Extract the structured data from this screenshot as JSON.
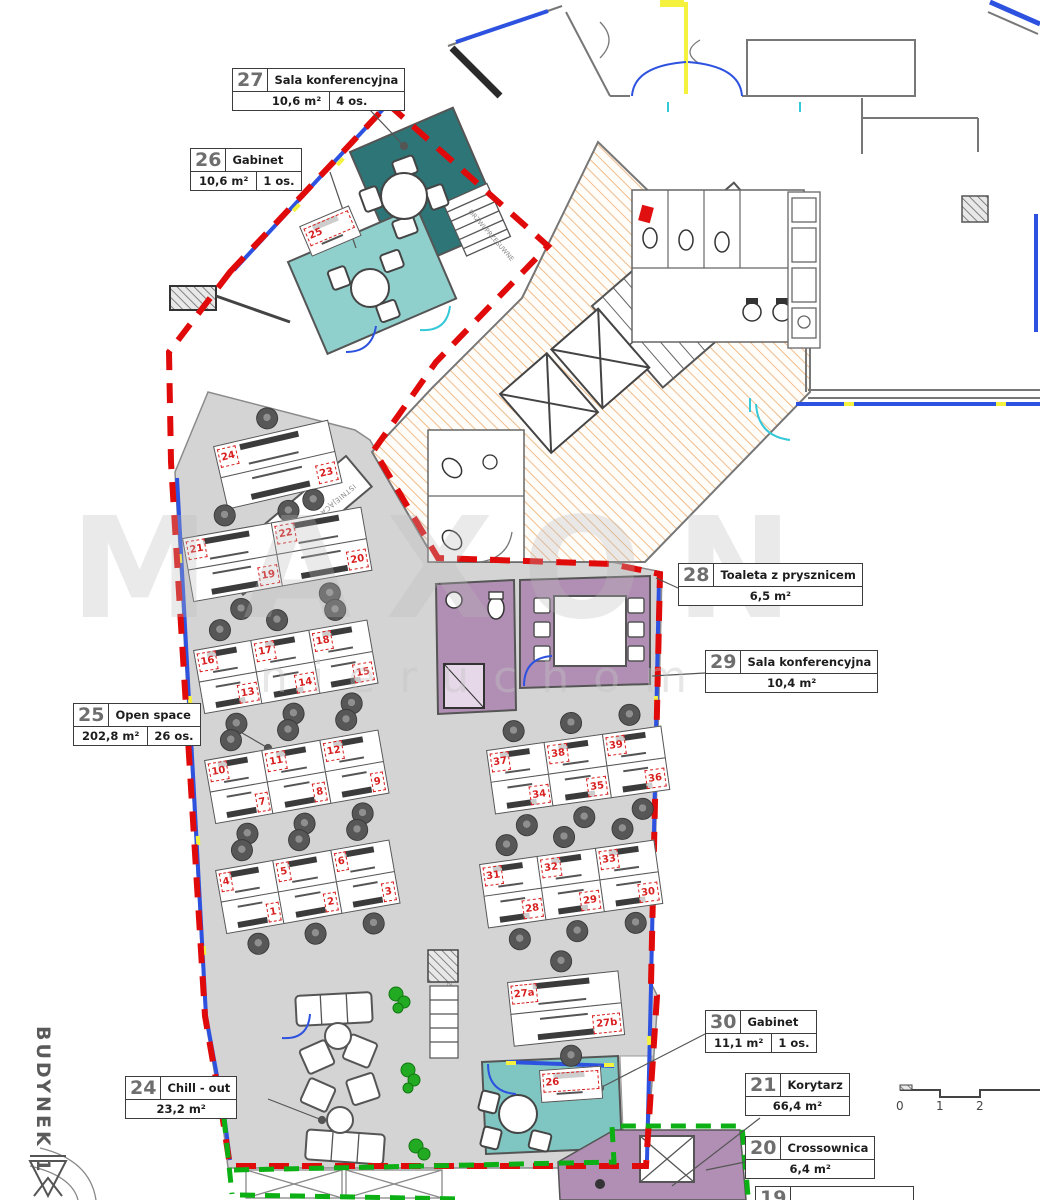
{
  "building_label": "BUDYNEK 1",
  "watermark": {
    "line1": "MAXON",
    "line2": "nieruchomości"
  },
  "scale_bar": {
    "ticks": [
      "0",
      "1",
      "2"
    ]
  },
  "room_labels": [
    {
      "id": "27",
      "name": "Sala konferencyjna",
      "area": "10,6 m²",
      "capacity": "4 os."
    },
    {
      "id": "26",
      "name": "Gabinet",
      "area": "10,6 m²",
      "capacity": "1 os."
    },
    {
      "id": "28",
      "name": "Toaleta z prysznicem",
      "area": "6,5 m²",
      "capacity": ""
    },
    {
      "id": "29",
      "name": "Sala konferencyjna",
      "area": "10,4 m²",
      "capacity": ""
    },
    {
      "id": "25",
      "name": "Open space",
      "area": "202,8 m²",
      "capacity": "26 os."
    },
    {
      "id": "24",
      "name": "Chill - out",
      "area": "23,2 m²",
      "capacity": ""
    },
    {
      "id": "30",
      "name": "Gabinet",
      "area": "11,1 m²",
      "capacity": "1 os."
    },
    {
      "id": "21",
      "name": "Korytarz",
      "area": "66,4 m²",
      "capacity": ""
    },
    {
      "id": "20",
      "name": "Crossownica",
      "area": "6,4 m²",
      "capacity": ""
    },
    {
      "id": "19",
      "name": "",
      "area": "",
      "capacity": ""
    }
  ],
  "annotations": {
    "builtin_furniture": "ISTNIEJĄCA ZABUDOWA MEBLOWA",
    "sliding_door_1": "DRZWI PRZESUWNE",
    "sliding_door_2": "DRZWI PRZESUWNE"
  },
  "desk_clusters": [
    {
      "rows": [
        [
          "24"
        ],
        [
          "23"
        ]
      ]
    },
    {
      "rows": [
        [
          "21",
          "22"
        ],
        [
          "19",
          "20"
        ]
      ]
    },
    {
      "rows": [
        [
          "16",
          "17",
          "18"
        ],
        [
          "13",
          "14",
          "15"
        ]
      ]
    },
    {
      "rows": [
        [
          "10",
          "11",
          "12"
        ],
        [
          "7",
          "8",
          "9"
        ]
      ]
    },
    {
      "rows": [
        [
          "4",
          "5",
          "6"
        ],
        [
          "1",
          "2",
          "3"
        ]
      ]
    },
    {
      "rows": [
        [
          "37",
          "38",
          "39"
        ],
        [
          "34",
          "35",
          "36"
        ]
      ]
    },
    {
      "rows": [
        [
          "31",
          "32",
          "33"
        ],
        [
          "28",
          "29",
          "30"
        ]
      ]
    },
    {
      "rows": [
        [
          "27a"
        ],
        [
          "27b"
        ]
      ]
    },
    {
      "rows": [
        [
          "25"
        ]
      ]
    },
    {
      "rows": [
        [
          "26"
        ]
      ]
    }
  ],
  "colors": {
    "red_boundary": "#e00a0a",
    "green_boundary": "#0cb014",
    "blue_window": "#2d52e0",
    "yellow_mark": "#f5f13f",
    "cyan_door": "#35c8d8",
    "teal_dark": "#2e7577",
    "teal_light": "#8fd0cd",
    "teal_room30": "#7fc6c2",
    "purple_room": "#b18fb4",
    "gray_floor": "#d4d4d4",
    "hatch_orange": "#f0bc8c",
    "desk_red": "#d81f1f",
    "wall": "#6e6e6e"
  }
}
